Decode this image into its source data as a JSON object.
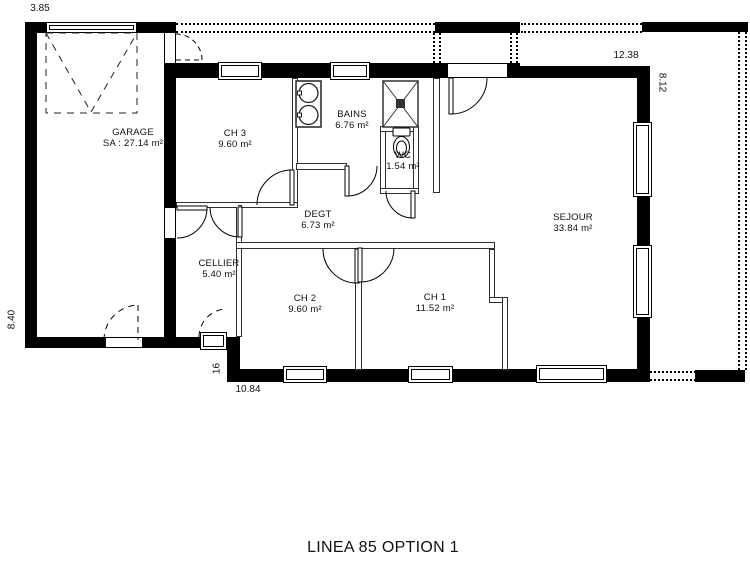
{
  "plan": {
    "title": "LINEA 85 OPTION 1"
  },
  "rooms": [
    {
      "name": "GARAGE",
      "area": "SA : 27.14 m²"
    },
    {
      "name": "CH 3",
      "area": "9.60 m²"
    },
    {
      "name": "BAINS",
      "area": "6.76 m²"
    },
    {
      "name": "WC",
      "area": "1.54 m²"
    },
    {
      "name": "SEJOUR",
      "area": "33.84 m²"
    },
    {
      "name": "DEGT",
      "area": "6.73 m²"
    },
    {
      "name": "CELLIER",
      "area": "5.40 m²"
    },
    {
      "name": "CH 2",
      "area": "9.60 m²"
    },
    {
      "name": "CH 1",
      "area": "11.52 m²"
    }
  ],
  "dimensions": {
    "garage_width": "3.85",
    "top_right_width": "12.38",
    "right_height": "8.12",
    "left_height": "8.40",
    "bottom_width": "10.84",
    "step_width": "16"
  },
  "fixtures": {
    "washbasin": "double-washbasin",
    "shower": "shower",
    "toilet": "toilet",
    "garage_door": "garage-door"
  }
}
